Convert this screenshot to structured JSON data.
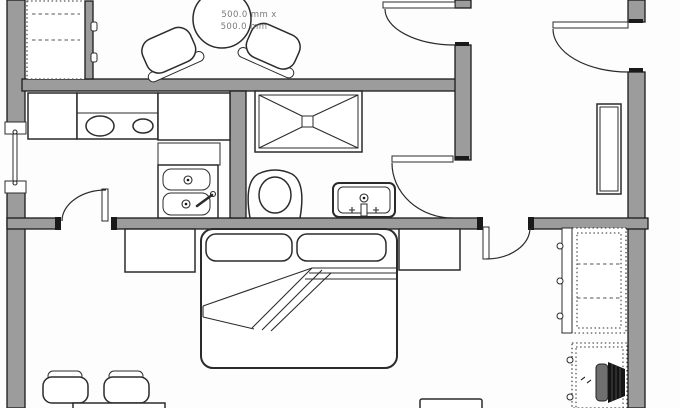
{
  "labels": {
    "table_dimensions_line1": "500.0 mm x",
    "table_dimensions_line2": "500.0 mm"
  },
  "colors": {
    "background": "#fdfdfd",
    "wall_fill": "#9c9c9c",
    "wall_stroke": "#1c1c1c",
    "line": "#2b2b2b",
    "label_text": "#7a7a7a",
    "chair_dark": "#141414",
    "chair_gray": "#6f6f6f"
  }
}
